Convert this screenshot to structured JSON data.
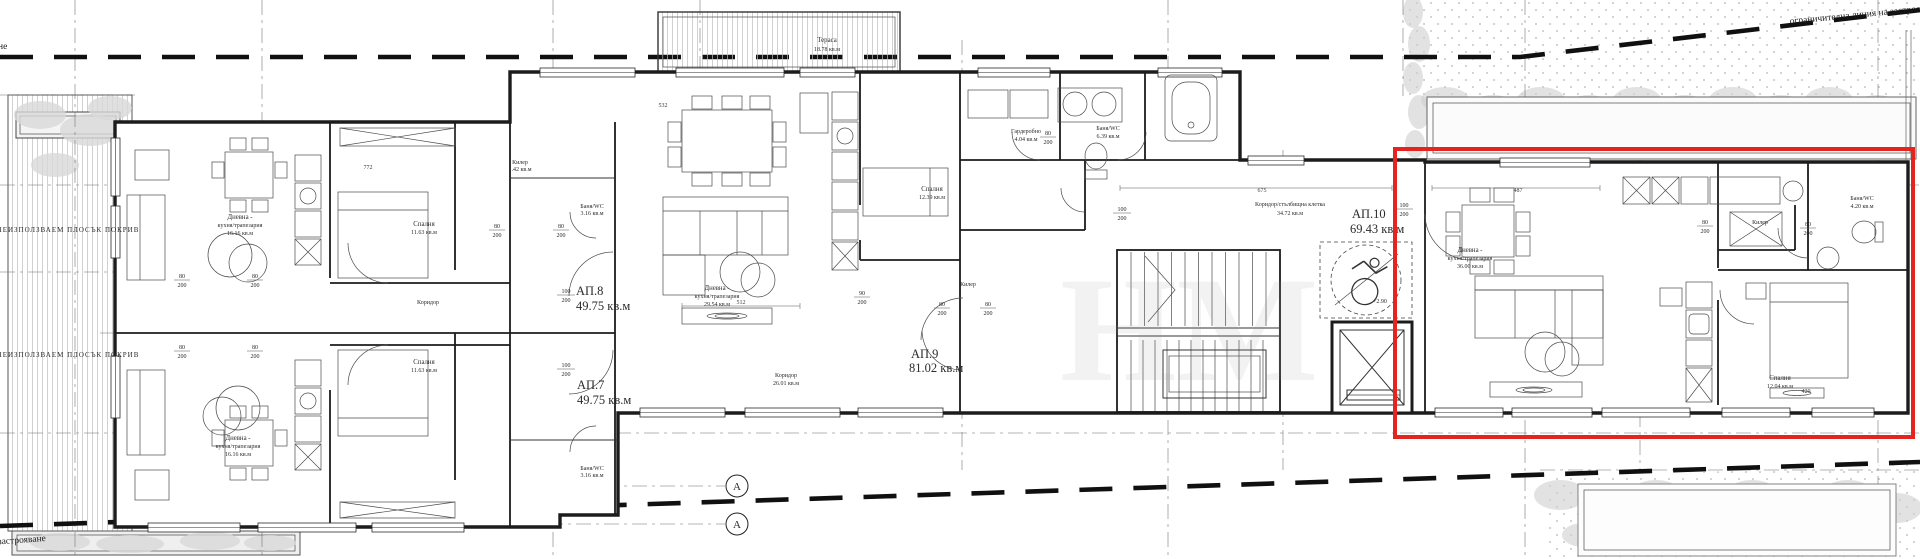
{
  "apartments": {
    "ap7": {
      "id": "АП.7",
      "area": "49.75 кв.м"
    },
    "ap8": {
      "id": "АП.8",
      "area": "49.75 кв.м"
    },
    "ap9": {
      "id": "АП.9",
      "area": "81.02 кв.м"
    },
    "ap10": {
      "id": "АП.10",
      "area": "69.43 кв.м"
    }
  },
  "labels": {
    "section_mark": "А",
    "terrace_name": "Тераса",
    "terrace_area": "18.78 кв.м",
    "stair_corr_name": "Коридор/стълбищна клетка",
    "stair_corr_area": "34.72 кв.м",
    "living_line1": "Дневна -",
    "living_line2": "кухня/трапезария",
    "living8_area": "16.16 кв.м",
    "living7_area": "16.16 кв.м",
    "living9_area": "29.54 кв.м",
    "living10_area": "36.00 кв.м",
    "bedroom": "Спалня",
    "bedroom8_area": "11.63 кв.м",
    "bedroom7_area": "11.63 кв.м",
    "bedroom9_area": "12.39 кв.м",
    "bedroom10_area": "12.04 кв.м",
    "corridor": "Коридор",
    "corridor9_area": "26.01 кв.м",
    "banya": "Баня/WC",
    "banya8_area": "3.16 кв.м",
    "banya7_area": "3.16 кв.м",
    "banya9_area": "6.39 кв.м",
    "banya10_area": "4.20 кв.м",
    "kiler": "Килер",
    "kiler_area": "1.42 кв.м",
    "garderobno": "Гардеробно",
    "garderobno_area": "4.04 кв.м",
    "roof_left": "НЕИЗПОЛЗВАЕМ ПЛОСЪК ПОКРИВ",
    "level": "+2.90",
    "boundary": "ограничителна линия на застрояване",
    "boundary_frag": "на застрояване",
    "corner_frag": "не",
    "watermark": "НМ"
  },
  "dims": {
    "n60": "60",
    "n80": "80",
    "n90": "90",
    "n100": "100",
    "n200": "200",
    "len675": "675",
    "len487": "487",
    "len512": "512",
    "len772": "772",
    "len532": "532",
    "len420": "420"
  },
  "highlight_color": "#e52420"
}
